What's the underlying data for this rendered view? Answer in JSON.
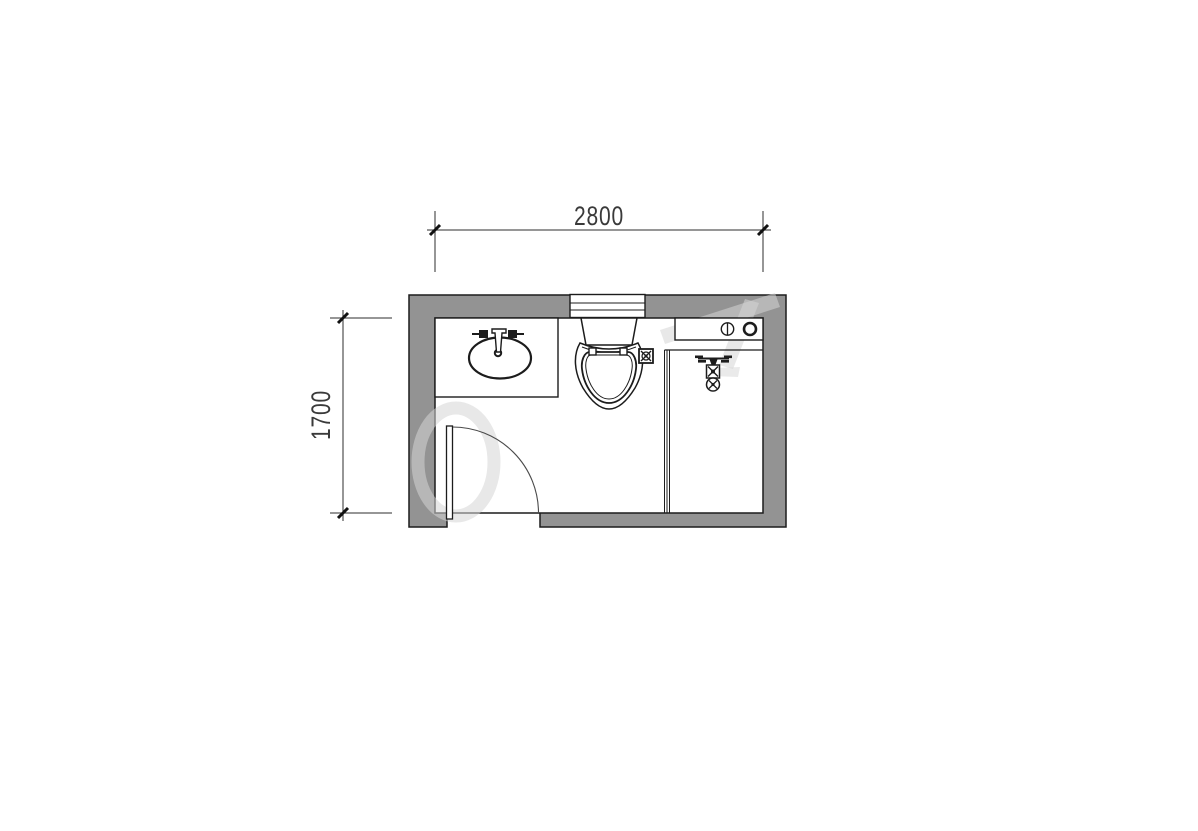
{
  "page": {
    "background_color": "#ffffff",
    "type": "architectural-floor-plan"
  },
  "floor_plan": {
    "dimensions": {
      "top": {
        "value": "2800"
      },
      "left": {
        "value": "1700"
      }
    },
    "colors": {
      "wall_fill": "#939393",
      "line": "#1c1c1c",
      "dimension_text": "#3a3a3a",
      "watermark": "rgba(213,213,213,0.55)"
    },
    "fixtures": [
      {
        "icon": "window-icon"
      },
      {
        "icon": "vanity-counter"
      },
      {
        "icon": "oval-sink-icon"
      },
      {
        "icon": "faucet-icon"
      },
      {
        "icon": "toilet-icon"
      },
      {
        "icon": "floor-drain-icon"
      },
      {
        "icon": "glass-partition"
      },
      {
        "icon": "laundry-counter"
      },
      {
        "icon": "valve-knob-icon"
      },
      {
        "icon": "drain-ring-icon"
      },
      {
        "icon": "shower-mixer-icon"
      },
      {
        "icon": "door-swing-icon"
      }
    ]
  }
}
